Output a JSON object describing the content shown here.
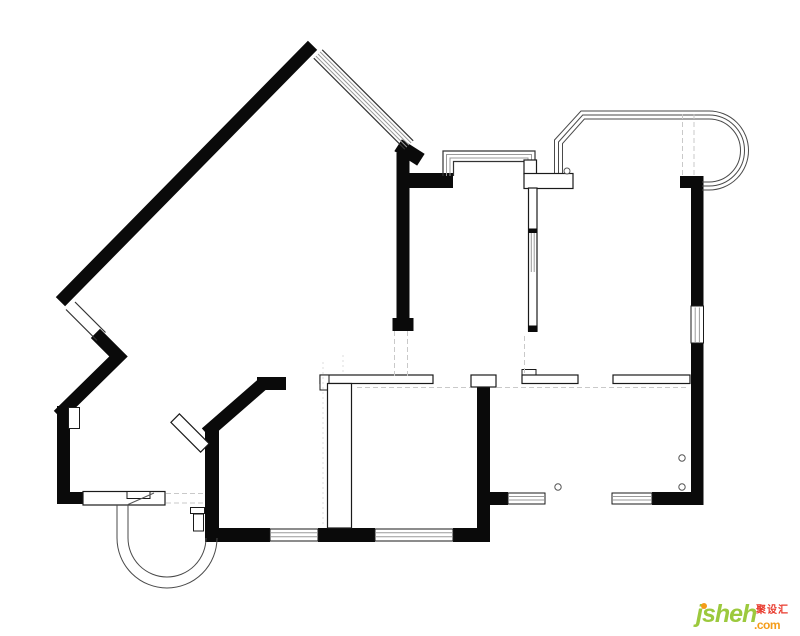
{
  "page": {
    "type": "architectural floor plan drawing",
    "description": "Black-and-white residential apartment floor plan: thick black exterior walls (one long 45-degree diagonal wall upper-left), thin white outlined interior partitions, hatched window bands, a rounded bay window at top right, a semicircular entry step arc at bottom left, dashed door-opening guides and small circular door knobs",
    "background": "#ffffff"
  },
  "colors": {
    "bg": "#ffffff",
    "wall": "#0a0a0a",
    "thin": "#1a1a1a",
    "outline": "#4a4a4a",
    "hatch": "#9a9a9a",
    "dash": "#c9c9c9",
    "faint": "#dcdcdc",
    "logo_green": "#9cc93d",
    "logo_orange": "#f49c19",
    "logo_red": "#e8392c"
  },
  "logo": {
    "brand": "jsheh",
    "tld": ".com",
    "cjk_label": "聚设汇"
  }
}
